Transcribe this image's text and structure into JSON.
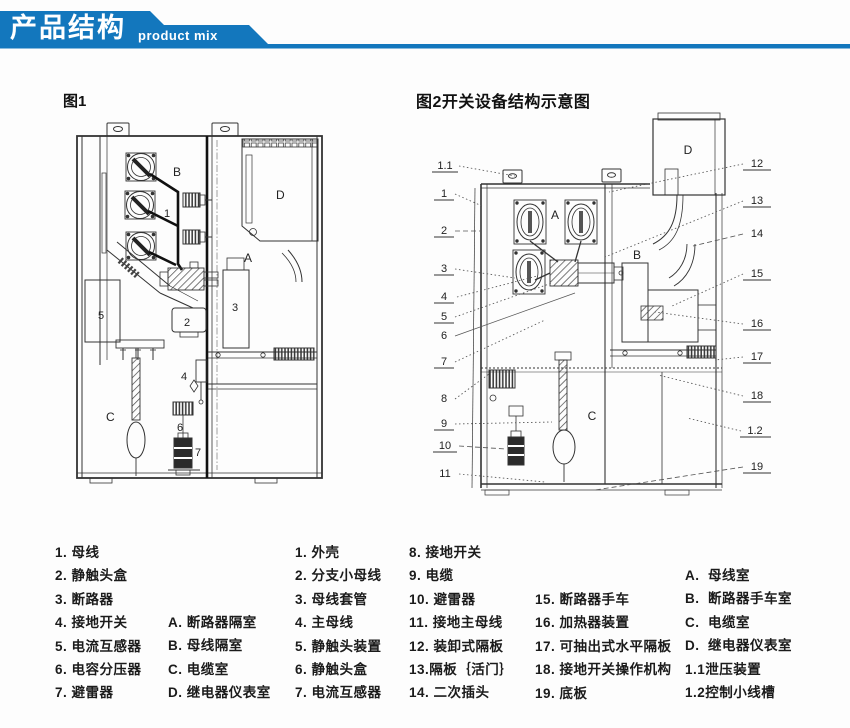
{
  "banner": {
    "title": "产品结构",
    "subtitle": "product mix",
    "color": "#1377bd"
  },
  "figure1": {
    "title": "图1",
    "part_numbers": [
      "1",
      "2",
      "3",
      "4",
      "5",
      "6",
      "7"
    ],
    "compartments": {
      "A": "A",
      "B": "B",
      "C": "C",
      "D": "D"
    }
  },
  "figure2": {
    "title": "图2开关设备结构示意图",
    "left_labels": [
      "1.1",
      "1",
      "2",
      "3",
      "4",
      "5",
      "6",
      "7",
      "8",
      "9",
      "10",
      "11"
    ],
    "right_labels": [
      "12",
      "13",
      "14",
      "15",
      "16",
      "17",
      "18",
      "1.2",
      "19"
    ],
    "compartments": {
      "A": "A",
      "B": "B",
      "C": "C",
      "D": "D"
    }
  },
  "legend": {
    "columns": [
      {
        "items": [
          "1. 母线",
          "2. 静触头盒",
          "3. 断路器",
          "4. 接地开关",
          "5. 电流互感器",
          "6. 电容分压器",
          "7. 避雷器"
        ]
      },
      {
        "items": [
          "A. 断路器隔室",
          "B. 母线隔室",
          "C. 电缆室",
          "D. 继电器仪表室"
        ]
      },
      {
        "items": [
          "1. 外壳",
          "2. 分支小母线",
          "3. 母线套管",
          "4. 主母线",
          "5. 静触头装置",
          "6. 静触头盒",
          "7. 电流互感器"
        ]
      },
      {
        "items": [
          "8. 接地开关",
          "9. 电缆",
          "10. 避雷器",
          "11. 接地主母线",
          "12. 装卸式隔板",
          "13.隔板｛活门｝",
          "14. 二次插头"
        ]
      },
      {
        "items": [
          "15. 断路器手车",
          "16. 加热器装置",
          "17. 可抽出式水平隔板",
          "18. 接地开关操作机构",
          "19. 底板"
        ]
      },
      {
        "items": [
          "A.  母线室",
          "B.  断路器手车室",
          "C.  电缆室",
          "D.  继电器仪表室",
          "1.1泄压装置",
          "1.2控制小线槽"
        ]
      }
    ]
  }
}
